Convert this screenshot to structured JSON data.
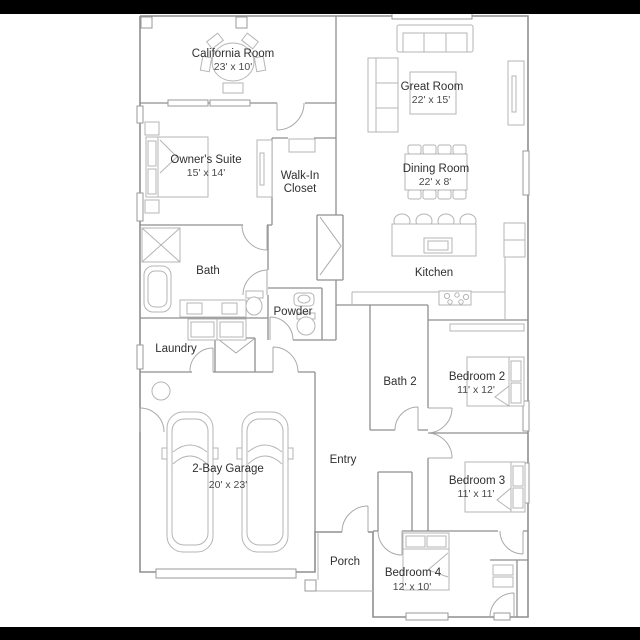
{
  "page": {
    "kind": "floor-plan",
    "background": "#ffffff",
    "letterbox_color": "#000000"
  },
  "plan": {
    "wall_color": "#8f8f8f",
    "furniture_color": "#b5b5b5",
    "label_color": "#2f2f2f",
    "dims_color": "#4a4a4a",
    "rooms": {
      "california_room": {
        "name": "California Room",
        "dims": "23' x 10'"
      },
      "great_room": {
        "name": "Great Room",
        "dims": "22' x 15'"
      },
      "owners_suite": {
        "name": "Owner's Suite",
        "dims": "15' x 14'"
      },
      "walk_in_closet": {
        "name_line1": "Walk-In",
        "name_line2": "Closet"
      },
      "dining_room": {
        "name": "Dining Room",
        "dims": "22' x 8'"
      },
      "bath": {
        "name": "Bath"
      },
      "kitchen": {
        "name": "Kitchen"
      },
      "powder": {
        "name": "Powder"
      },
      "laundry": {
        "name": "Laundry"
      },
      "bath_2": {
        "name": "Bath 2"
      },
      "bedroom_2": {
        "name": "Bedroom 2",
        "dims": "11' x 12'"
      },
      "garage": {
        "name": "2-Bay Garage",
        "dims": "20' x 23'"
      },
      "entry": {
        "name": "Entry"
      },
      "bedroom_3": {
        "name": "Bedroom 3",
        "dims": "11' x 11'"
      },
      "porch": {
        "name": "Porch"
      },
      "bedroom_4": {
        "name": "Bedroom 4",
        "dims": "12' x 10'"
      }
    }
  }
}
